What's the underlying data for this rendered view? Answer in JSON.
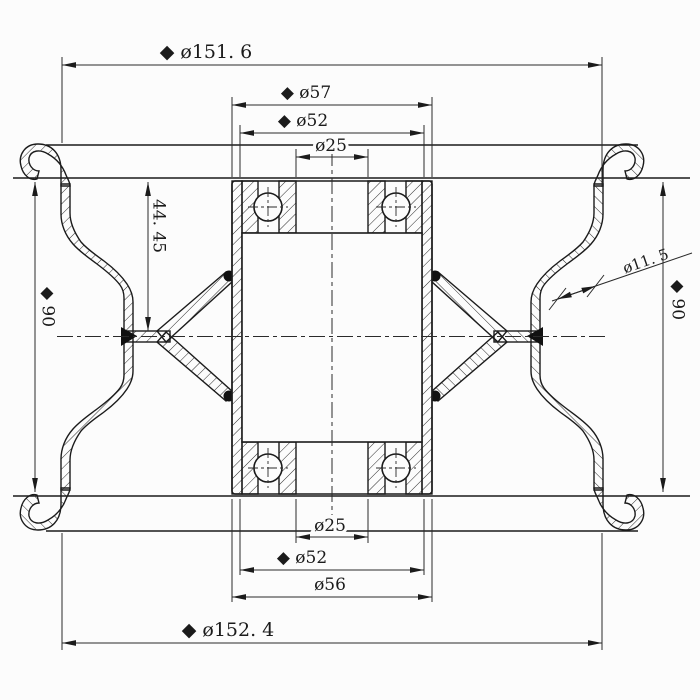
{
  "colors": {
    "ink": "#1b1b1b",
    "background": "#fcfcfc"
  },
  "dimensions": {
    "top_flange_diameter": "◆ ø151. 6",
    "hub_outer_top": "◆ ø57",
    "hub_step_top": "◆ ø52",
    "bore_top": "ø25",
    "bead_offset": "44. 45",
    "rim_width_left": "◆ 90",
    "wall_section": "ø11. 5",
    "rim_width_right": "◆ 90",
    "bore_bottom": "ø25",
    "hub_step_bottom": "◆ ø52",
    "hub_outer_bottom": "ø56",
    "bottom_flange_diameter": "◆ ø152. 4"
  }
}
